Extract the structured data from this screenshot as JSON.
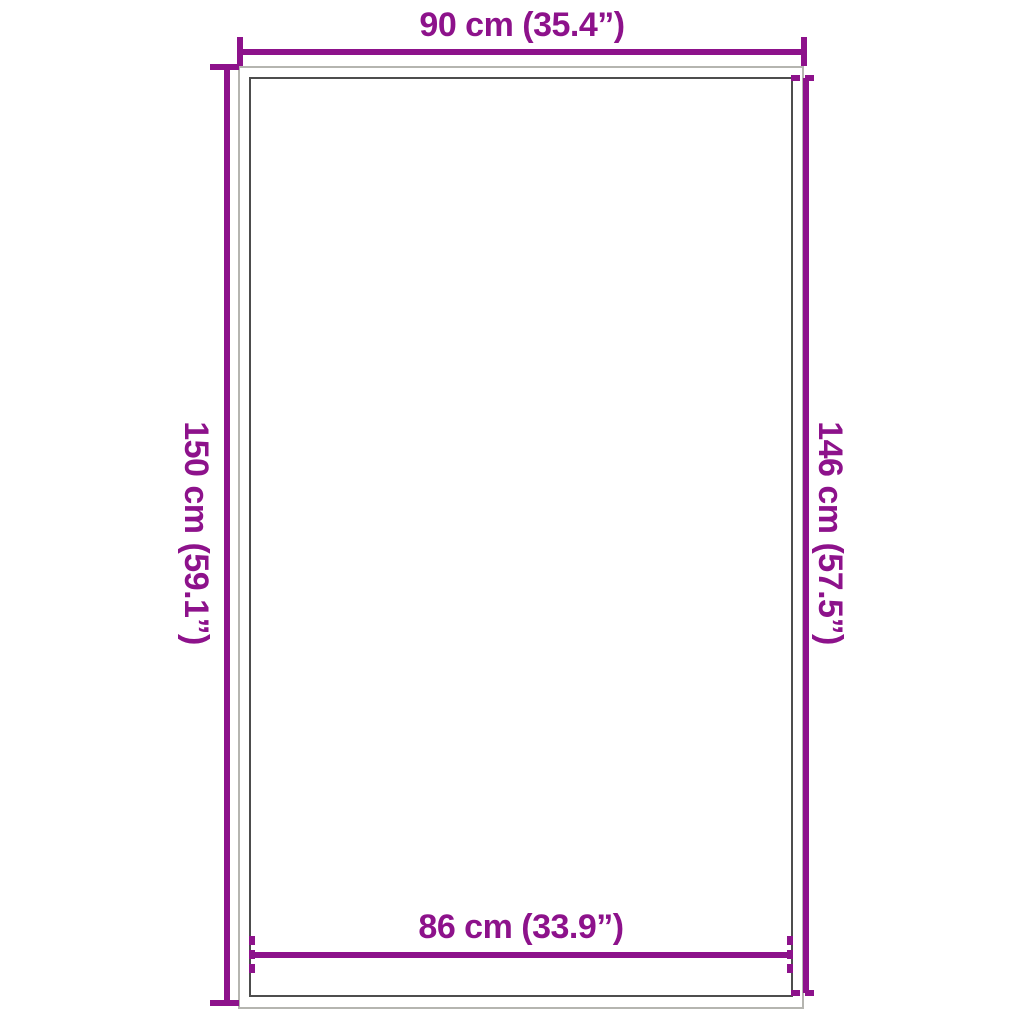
{
  "diagram": {
    "type": "product-dimension-diagram",
    "colors": {
      "accent": "#8d128b",
      "outer-outline": "#b5b5b0",
      "inner-outline": "#4d4d4d",
      "page-bg": "#ffffff"
    },
    "dimensions": {
      "top": {
        "label": "90 cm (35.4”)",
        "cm": "90",
        "inches": "35.4",
        "tick_style": "solid"
      },
      "left": {
        "label": "150 cm (59.1”)",
        "cm": "150",
        "inches": "59.1",
        "tick_style": "solid"
      },
      "right": {
        "label": "146 cm (57.5”)",
        "cm": "146",
        "inches": "57.5",
        "tick_style": "dashed"
      },
      "bottom": {
        "label": "86 cm (33.9”)",
        "cm": "86",
        "inches": "33.9",
        "tick_style": "dashed"
      }
    }
  }
}
